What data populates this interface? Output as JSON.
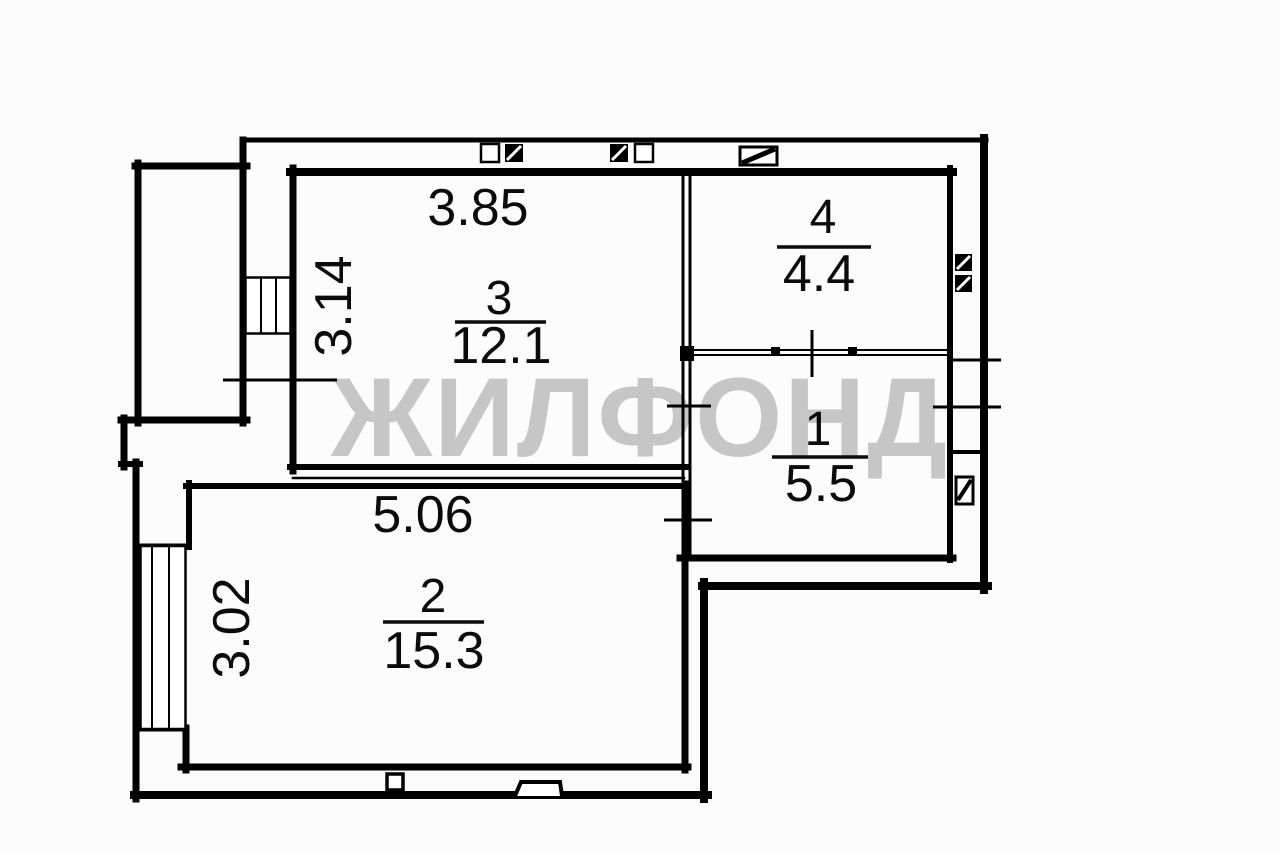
{
  "watermark": "ЖИЛФОНД",
  "colors": {
    "wall": "#000000",
    "background": "#fcfcfc",
    "watermark": "#c6c6c6",
    "label": "#0b0b0b"
  },
  "rooms": {
    "room1": {
      "number": "1",
      "area": "5.5"
    },
    "room2": {
      "number": "2",
      "area": "15.3",
      "width_m": "5.06",
      "depth_m": "3.02"
    },
    "room3": {
      "number": "3",
      "area": "12.1",
      "width_m": "3.85",
      "depth_m": "3.14"
    },
    "room4": {
      "number": "4",
      "area": "4.4"
    }
  },
  "symbols": {
    "window": "window",
    "vent": "vent-shaft",
    "entry_door": "entry-door",
    "porch": "porch-step"
  }
}
